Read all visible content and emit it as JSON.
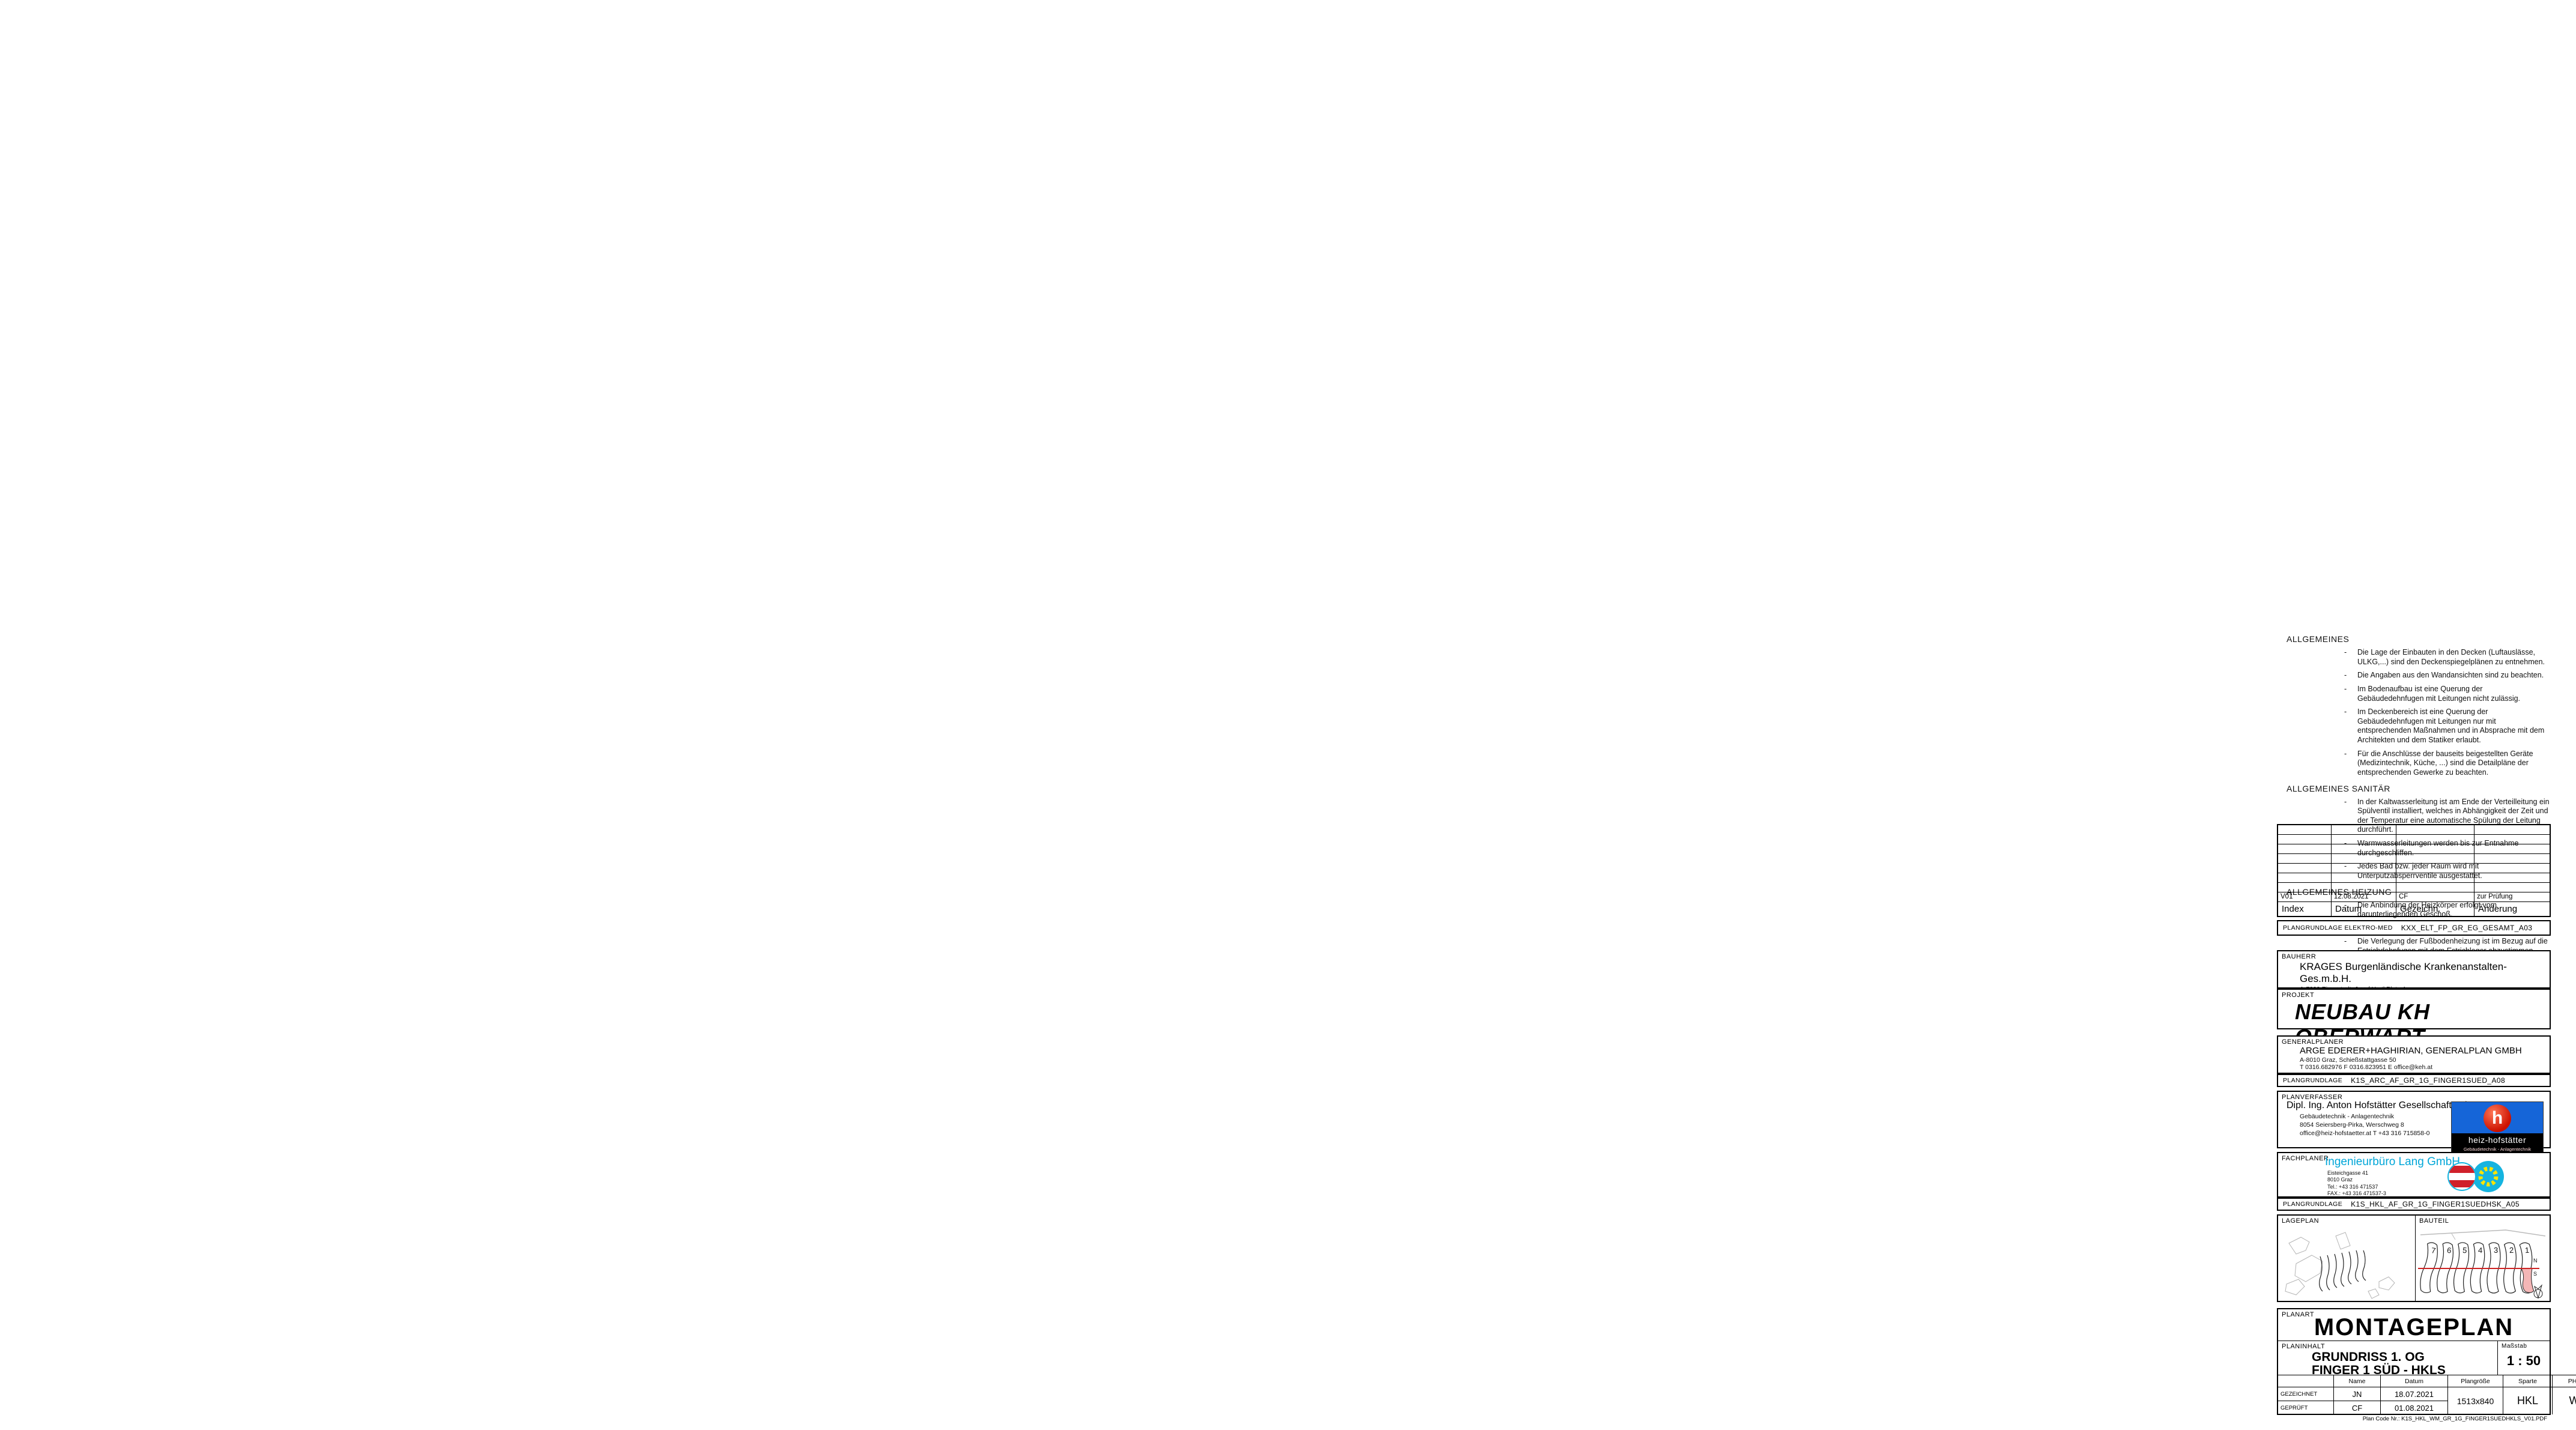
{
  "panel": {
    "notes": {
      "allgemeines_title": "ALLGEMEINES",
      "allgemeines": [
        "Die Lage der Einbauten in den Decken (Luftauslässe, ULKG,...) sind den Deckenspiegelplänen zu entnehmen.",
        "Die Angaben aus den Wandansichten sind zu beachten.",
        "Im Bodenaufbau ist eine Querung der Gebäudedehnfugen mit Leitungen nicht zulässig.",
        "Im Deckenbereich ist eine Querung der Gebäudedehnfugen mit Leitungen nur mit entsprechenden Maßnahmen und in Absprache mit dem Architekten und dem Statiker erlaubt.",
        "Für die Anschlüsse der bauseits beigestellten Geräte (Medizintechnik, Küche, ...) sind die Detailpläne der entsprechenden Gewerke zu beachten."
      ],
      "sanitaer_title": "ALLGEMEINES SANITÄR",
      "sanitaer": [
        "In der Kaltwasserleitung ist am Ende der Verteilleitung ein Spülventil installiert, welches in Abhängigkeit der Zeit und der Temperatur eine automatische Spülung der Leitung durchführt.",
        "Warmwasserleitungen werden bis zur Entnahme durchgeschliffen.",
        "Jedes Bad bzw. jeder Raum wird mit Unterputzabsperrventile ausgestattet."
      ],
      "heizung_title": "ALLGEMEINES HEIZUNG",
      "heizung": [
        "Die Anbindung der Heizkörper erfolgt vom darunterliegenden Geschoß.",
        "Verbindungsstellen im Bodenaufbau sind zu vermeiden.",
        "Die Verlegung der Fußbodenheizung ist im Bezug auf die Estrichdehnfugen mit dem Estrichleger abzustimmen.",
        "Bei der Querung der Estrichdehnfugen sind Schutzrohre vorzusehen."
      ]
    },
    "revision": {
      "headers": [
        "Index",
        "Datum",
        "Gezeichn.",
        "Änderung"
      ],
      "row": [
        "V01",
        "12.08.2021",
        "CF",
        "zur Prüfung"
      ],
      "empty_count": 7
    },
    "plangrundlage_elektro": {
      "label": "PLANGRUNDLAGE ELEKTRO-MED",
      "value": "KXX_ELT_FP_GR_EG_GESAMT_A03"
    },
    "bauherr": {
      "label": "BAUHERR",
      "name": "KRAGES Burgenländische Krankenanstalten-Ges.m.b.H.",
      "address": "A-7000 Eisenstadt, Josef Hyrtl Platz 4",
      "contact": "T 057979-3060       F 057979-5306       E direktion@krages.at"
    },
    "projekt": {
      "label": "PROJEKT",
      "name": "NEUBAU KH OBERWART"
    },
    "generalplaner": {
      "label": "GENERALPLANER",
      "name": "ARGE EDERER+HAGHIRIAN, GENERALPLAN GMBH",
      "address": "A-8010 Graz, Schießstattgasse 50",
      "contact": "T 0316.682976       F 0316.823951       E office@keh.at",
      "plangrundlage_label": "PLANGRUNDLAGE",
      "plangrundlage": "K1S_ARC_AF_GR_1G_FINGER1SUED_A08"
    },
    "planverfasser": {
      "label": "PLANVERFASSER",
      "name": "Dipl. Ing. Anton Hofstätter Gesellschaft m.b.H.",
      "line2": "Gebäudetechnik - Anlagentechnik",
      "line3": "8054 Seiersberg-Pirka, Werschweg 8",
      "line4": "office@heiz-hofstaetter.at          T +43 316 715858-0",
      "logo_h": "h",
      "logo_text": "heiz-hofstätter",
      "logo_sub": "Gebäudetechnik - Anlagentechnik"
    },
    "fachplaner": {
      "label": "FACHPLANER",
      "name": "Ingenieurbüro Lang GmbH",
      "l1": "Eisteichgasse            41",
      "l2": "8010                    Graz",
      "l3": "Tel.:     +43 316 471537",
      "l4": "FAX.:  +43 316 471537-3",
      "l5": "email:   office@ib-lang.at",
      "plangrundlage_label": "PLANGRUNDLAGE",
      "plangrundlage": "K1S_HKL_AF_GR_1G_FINGER1SUEDHSK_A05"
    },
    "lageplan_label": "LAGEPLAN",
    "bauteil_label": "BAUTEIL",
    "bauteil": {
      "numbers": [
        "7",
        "6",
        "5",
        "4",
        "3",
        "2",
        "1"
      ],
      "north": "N",
      "south": "S"
    },
    "titleblock": {
      "planart_label": "PLANART",
      "planart": "MONTAGEPLAN",
      "planinhalt_label": "PLANINHALT",
      "inhalt1": "GRUNDRISS 1. OG",
      "inhalt2": "FINGER 1 SÜD - HKLS",
      "massstab_label": "Maßstab",
      "massstab": "1 : 50",
      "col_name": "Name",
      "col_datum": "Datum",
      "col_groesse": "Plangröße",
      "col_sparte": "Sparte",
      "col_phase": "PHASE",
      "col_index": "INDEX",
      "row1_label": "GEZEICHNET",
      "row1_name": "JN",
      "row1_datum": "18.07.2021",
      "row2_label": "GEPRÜFT",
      "row2_name": "CF",
      "row2_datum": "01.08.2021",
      "plangroesse": "1513x840",
      "sparte": "HKL",
      "phase": "WM",
      "index": "V01",
      "plancode": "Plan Code Nr.: K1S_HKL_WM_GR_1G_FINGER1SUEDHKLS_V01.PDF"
    }
  },
  "plan": {
    "grid_top": [
      "51",
      "50",
      "49",
      "46",
      "45",
      "44",
      "43"
    ],
    "grid_special": "52",
    "grid_bottom": [
      "48",
      "47"
    ],
    "grid_letters": [
      "C",
      "A"
    ],
    "rooms": [
      {
        "lines": [
          "1.147B00",
          "Besprechung",
          "Kunststoff",
          "F 13.57 m²",
          "U 17.00 m",
          "RH 3.00 m",
          "FB018",
          "DE01c"
        ]
      },
      {
        "lines": [
          "1.147B01",
          "Büro PM/Benutz. Bet.",
          "Kunststoff",
          "F 14.44 m²",
          "U 16.10 m",
          "RH 3.00 m",
          "FB018",
          "DE01c"
        ]
      },
      {
        "lines": [
          "1.147B02",
          "Schreibzone",
          "Kunststoff",
          "F 19.20 m²",
          "U 17.80 m",
          "RH 3.00 m",
          "FB018",
          "DE01c"
        ]
      },
      {
        "lines": [
          "1.143600",
          "TH 1A",
          "Fliesen",
          "F 15.68 m²",
          "U 16.60 m",
          "RH 3.75 m",
          "FB05a"
        ]
      }
    ],
    "door_tags": [
      "11.47B00.01",
      "11.47B01.01"
    ],
    "spec_lines": [
      "VN-T6+HYGIENE Mittenanschlussheizkörper",
      "Type 30VM",
      "L=1800 mm H=600 mm",
      "25 kg/h   936 Watt",
      "UK=FFOK+150 mm   RW=0.87m"
    ],
    "green_note": [
      "Heizkörperanbindung",
      "Überströmung überprüfen",
      "lt. Planung"
    ],
    "labels": {
      "lounge": "LOUNGE PERSONAL",
      "verwaltung": "X.1.2 ALLGEMEINE VERWALTUNG",
      "speisenvers": "PERSONALSPEISENVERS",
      "bereich": "ereich!",
      "aw02": "AW02",
      "aw09": "AW09",
      "axis": "1.1A",
      "rph1": "RPH 1.02",
      "rph2": "FPH 1.02",
      "rph3": "STOK +7.20",
      "vdi": "VDI7 D 1 HM/BB LH",
      "kdk": "Systemair KDK 315",
      "dn": "Dx41x08"
    },
    "dims_top": [
      "300",
      "290",
      "360",
      "30",
      "40",
      "770",
      "15",
      "310"
    ],
    "dims_south": [
      "770",
      "280",
      "15",
      "107",
      "150",
      "1397"
    ],
    "dims_east": [
      "565",
      "489",
      "510",
      "402"
    ],
    "colors": {
      "pipe_magenta": "#ee00ee",
      "pipe_yellow": "#e8d900",
      "grid_cyan": "#00a6b8",
      "hatch_red": "#cc2222",
      "note_green": "#1a8a1a",
      "accent_red": "#dd1111",
      "equip_blue": "#2f8fd8"
    }
  }
}
